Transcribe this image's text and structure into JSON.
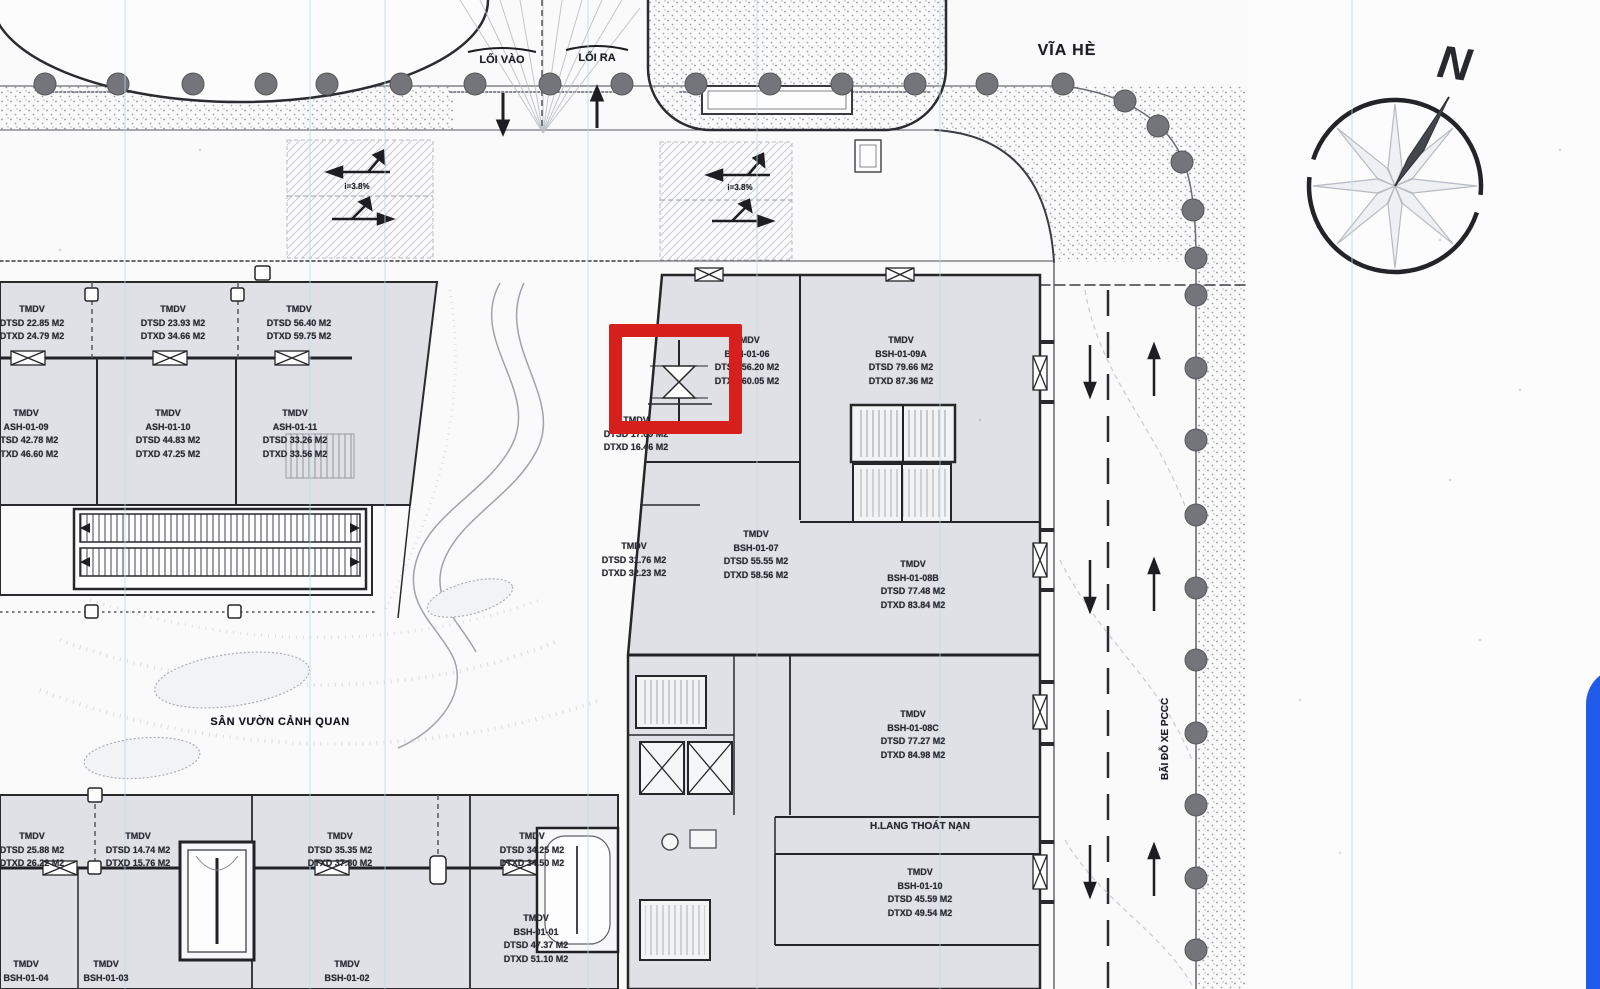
{
  "plan": {
    "road_labels": {
      "via_he": "VĨA HÈ",
      "loi_vao": "LỐI VÀO",
      "loi_ra": "LỐI RA",
      "bai_do_xe_pccc": "BÃI ĐỖ XE PCCC",
      "san_vuon_canh_quan": "SÂN VƯỜN CẢNH QUAN",
      "slope_left": "i=3.8%",
      "slope_center": "i=3.8%"
    },
    "compass": {
      "north_label": "N"
    },
    "unit_labels": [
      {
        "x": 32,
        "y": 303,
        "lines": [
          "TMDV",
          "DTSD 22.85 M2",
          "DTXD 24.79 M2"
        ]
      },
      {
        "x": 173,
        "y": 303,
        "lines": [
          "TMDV",
          "DTSD 23.93 M2",
          "DTXD 34.66 M2"
        ]
      },
      {
        "x": 299,
        "y": 303,
        "lines": [
          "TMDV",
          "DTSD 56.40 M2",
          "DTXD 59.75 M2"
        ]
      },
      {
        "x": 26,
        "y": 407,
        "lines": [
          "TMDV",
          "ASH-01-09",
          "DTSD 42.78 M2",
          "DTXD 46.60 M2"
        ]
      },
      {
        "x": 168,
        "y": 407,
        "lines": [
          "TMDV",
          "ASH-01-10",
          "DTSD 44.83 M2",
          "DTXD 47.25 M2"
        ]
      },
      {
        "x": 295,
        "y": 407,
        "lines": [
          "TMDV",
          "ASH-01-11",
          "DTSD 33.26 M2",
          "DTXD 33.56 M2"
        ]
      },
      {
        "x": 747,
        "y": 334,
        "lines": [
          "TMDV",
          "BSH-01-06",
          "DTSD 56.20 M2",
          "DTXD 60.05 M2"
        ]
      },
      {
        "x": 901,
        "y": 334,
        "lines": [
          "TMDV",
          "BSH-01-09A",
          "DTSD 79.66 M2",
          "DTXD 87.36 M2"
        ]
      },
      {
        "x": 636,
        "y": 414,
        "lines": [
          "TMDV",
          "DTSD 17.69 M2",
          "DTXD 16.46 M2"
        ]
      },
      {
        "x": 634,
        "y": 540,
        "lines": [
          "TMDV",
          "DTSD 31.76 M2",
          "DTXD 32.23 M2"
        ]
      },
      {
        "x": 756,
        "y": 528,
        "lines": [
          "TMDV",
          "BSH-01-07",
          "DTSD 55.55 M2",
          "DTXD 58.56 M2"
        ]
      },
      {
        "x": 913,
        "y": 558,
        "lines": [
          "TMDV",
          "BSH-01-08B",
          "DTSD 77.48 M2",
          "DTXD 83.84 M2"
        ]
      },
      {
        "x": 913,
        "y": 708,
        "lines": [
          "TMDV",
          "BSH-01-08C",
          "DTSD 77.27 M2",
          "DTXD 84.98 M2"
        ]
      },
      {
        "x": 920,
        "y": 820,
        "size": 10,
        "lines": [
          "H.LANG THOÁT NẠN"
        ]
      },
      {
        "x": 920,
        "y": 866,
        "lines": [
          "TMDV",
          "BSH-01-10",
          "DTSD 45.59 M2",
          "DTXD 49.54 M2"
        ]
      },
      {
        "x": 32,
        "y": 830,
        "lines": [
          "TMDV",
          "DTSD 25.88 M2",
          "DTXD 26.22 M2"
        ]
      },
      {
        "x": 138,
        "y": 830,
        "lines": [
          "TMDV",
          "DTSD 14.74 M2",
          "DTXD 15.76 M2"
        ]
      },
      {
        "x": 340,
        "y": 830,
        "lines": [
          "TMDV",
          "DTSD 35.35 M2",
          "DTXD 37.80 M2"
        ]
      },
      {
        "x": 532,
        "y": 830,
        "lines": [
          "TMDV",
          "DTSD 34.25 M2",
          "DTXD 34.50 M2"
        ]
      },
      {
        "x": 536,
        "y": 912,
        "lines": [
          "TMDV",
          "BSH-01-01",
          "DTSD 47.37 M2",
          "DTXD 51.10 M2"
        ]
      },
      {
        "x": 26,
        "y": 958,
        "lines": [
          "TMDV",
          "BSH-01-04"
        ]
      },
      {
        "x": 106,
        "y": 958,
        "lines": [
          "TMDV",
          "BSH-01-03"
        ]
      },
      {
        "x": 347,
        "y": 958,
        "lines": [
          "TMDV",
          "BSH-01-02"
        ]
      }
    ]
  },
  "colors": {
    "paper": "#fbfbfc",
    "building_fill": "#e0e1e6",
    "line_ink": "#26262b",
    "tree_gray": "#73757a",
    "highlight_red": "#d7201b",
    "accent_blue": "#1f5be8",
    "cyan_guide": "#b8dce8"
  }
}
